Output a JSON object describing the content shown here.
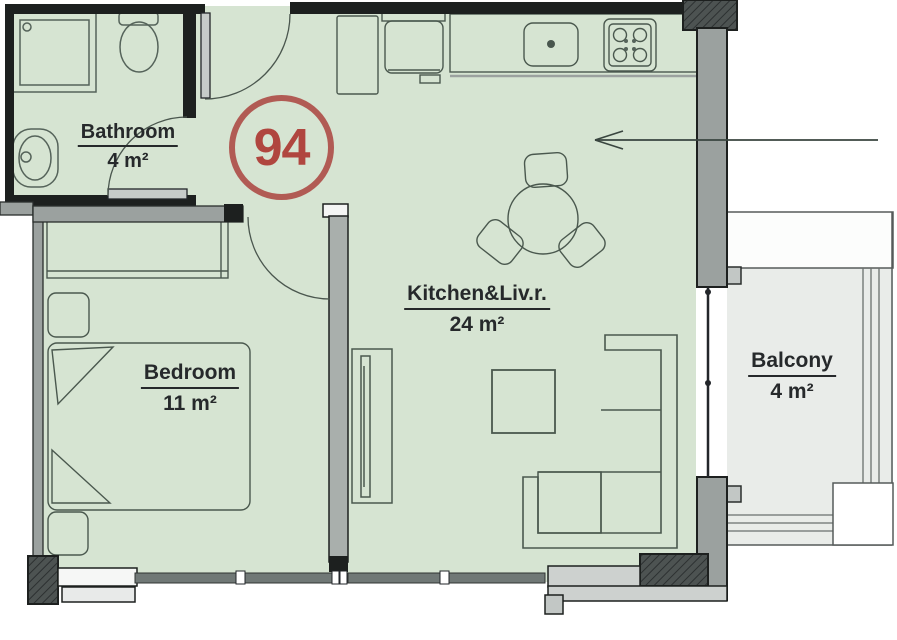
{
  "plan": {
    "unit_number": "94",
    "rooms": [
      {
        "name": "Bathroom",
        "area": "4 m²"
      },
      {
        "name": "Bedroom",
        "area": "11 m²"
      },
      {
        "name": "Kitchen&Liv.r.",
        "area": "24 m²"
      },
      {
        "name": "Balcony",
        "area": "4 m²"
      }
    ],
    "colors": {
      "floor": "#d6e4d2",
      "balcony_floor": "#e9ece9",
      "wall_dark": "#1d201f",
      "wall_gray": "#9ba19f",
      "window_gray": "#707876",
      "badge_ring": "#b15b54",
      "badge_text": "#b0463f",
      "label_text": "#26292b",
      "furniture_stroke": "#4a584e"
    },
    "fixtures": [
      "shower",
      "toilet",
      "wash-basin",
      "kitchen-counter",
      "kitchen-sink",
      "stove",
      "fridge",
      "entry-cabinet",
      "dining-table",
      "chairs",
      "tv-unit",
      "coffee-table",
      "corner-sofa",
      "wardrobe",
      "double-bed",
      "nightstands",
      "balcony-railing"
    ]
  }
}
